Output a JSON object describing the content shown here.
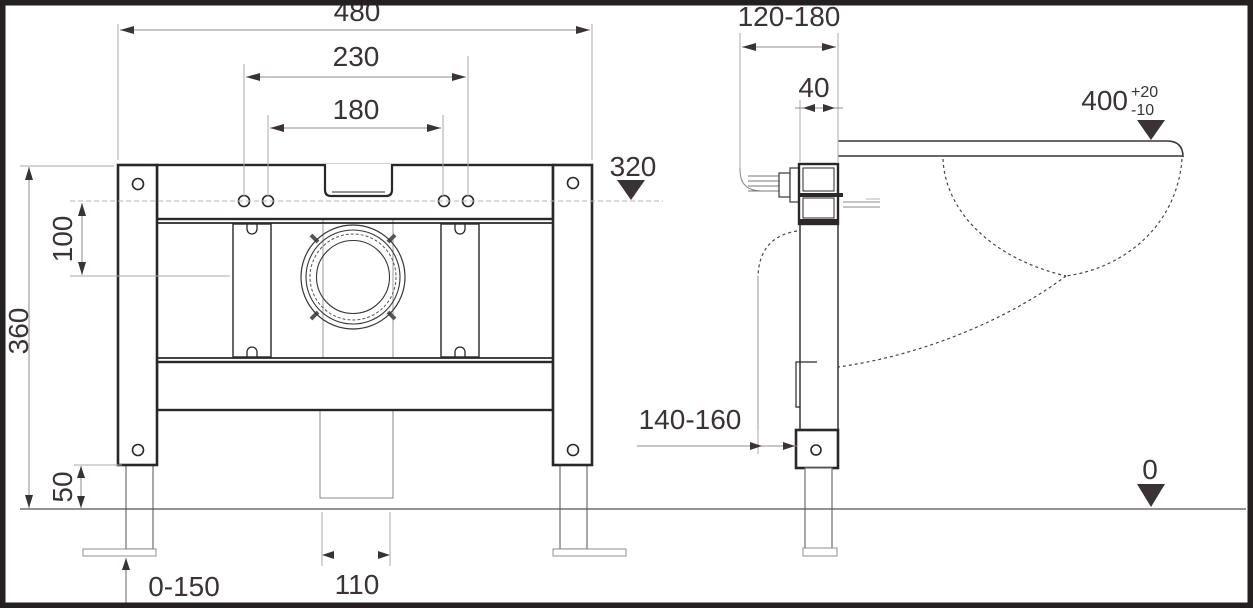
{
  "dims": {
    "front": {
      "overall_width": "480",
      "outer_hole_spacing": "230",
      "inner_hole_spacing": "180",
      "hole_height_datum": "320",
      "hole_to_drain_offset": "100",
      "frame_height": "360",
      "foot_clearance": "50",
      "foot_adjustment": "0-150",
      "drain_pipe_width": "110"
    },
    "side": {
      "wall_offset_range": "120-180",
      "frame_depth": "40",
      "rim_height": "400",
      "rim_tolerance_plus": "+20",
      "rim_tolerance_minus": "-10",
      "outlet_adjustment": "140-160",
      "floor_datum": "0"
    }
  }
}
